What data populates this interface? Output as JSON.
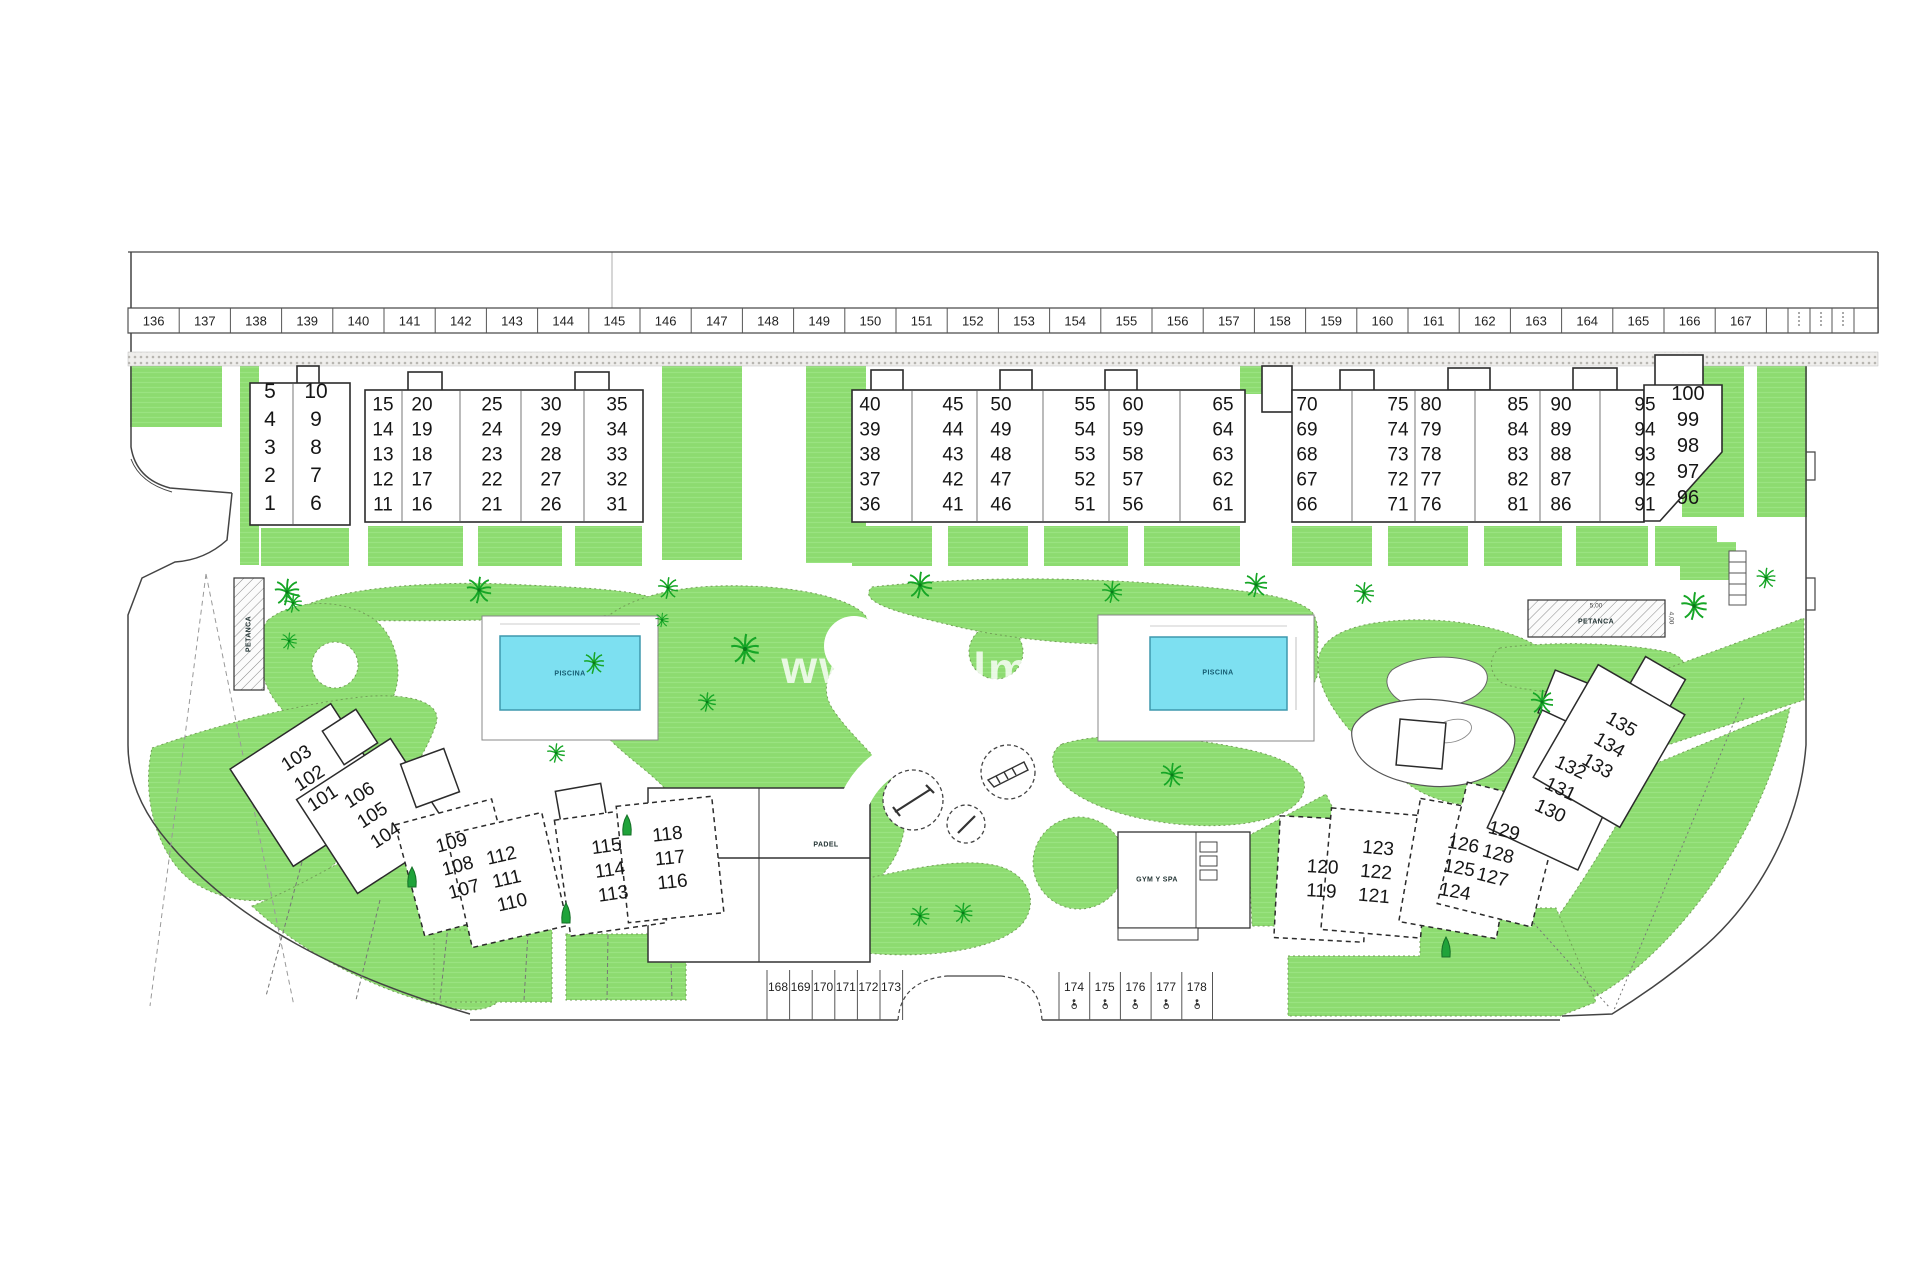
{
  "watermark": {
    "prefix": "www",
    "fragment": "dpalme"
  },
  "parking_top": [
    "136",
    "137",
    "138",
    "139",
    "140",
    "141",
    "142",
    "143",
    "144",
    "145",
    "146",
    "147",
    "148",
    "149",
    "150",
    "151",
    "152",
    "153",
    "154",
    "155",
    "156",
    "157",
    "158",
    "159",
    "160",
    "161",
    "162",
    "163",
    "164",
    "165",
    "166",
    "167"
  ],
  "parking_bottom_left": [
    "168",
    "169",
    "170",
    "171",
    "172",
    "173"
  ],
  "parking_bottom_right": [
    "174",
    "175",
    "176",
    "177",
    "178"
  ],
  "units_upper": [
    [
      5,
      4,
      3,
      2,
      1
    ],
    [
      10,
      9,
      8,
      7,
      6
    ],
    [
      15,
      14,
      13,
      12,
      11
    ],
    [
      20,
      19,
      18,
      17,
      16
    ],
    [
      25,
      24,
      23,
      22,
      21
    ],
    [
      30,
      29,
      28,
      27,
      26
    ],
    [
      35,
      34,
      33,
      32,
      31
    ],
    [
      40,
      39,
      38,
      37,
      36
    ],
    [
      45,
      44,
      43,
      42,
      41
    ],
    [
      50,
      49,
      48,
      47,
      46
    ],
    [
      55,
      54,
      53,
      52,
      51
    ],
    [
      60,
      59,
      58,
      57,
      56
    ],
    [
      65,
      64,
      63,
      62,
      61
    ],
    [
      70,
      69,
      68,
      67,
      66
    ],
    [
      75,
      74,
      73,
      72,
      71
    ],
    [
      80,
      79,
      78,
      77,
      76
    ],
    [
      85,
      84,
      83,
      82,
      81
    ],
    [
      90,
      89,
      88,
      87,
      86
    ],
    [
      95,
      94,
      93,
      92,
      91
    ],
    [
      100,
      99,
      98,
      97,
      96
    ]
  ],
  "units_lower": [
    [
      103,
      102,
      101
    ],
    [
      106,
      105,
      104
    ],
    [
      109,
      108,
      107
    ],
    [
      112,
      111,
      110
    ],
    [
      115,
      114,
      113
    ],
    [
      118,
      117,
      116
    ],
    [
      120,
      119
    ],
    [
      123,
      122,
      121
    ],
    [
      126,
      125,
      124
    ],
    [
      129,
      128,
      127
    ],
    [
      132,
      131,
      130
    ],
    [
      135,
      134,
      133
    ]
  ],
  "facilities": {
    "pool_label": "PISCINA",
    "petanca_label": "PETANCA",
    "petanca_dim_w": "5,00",
    "petanca_dim_h": "4,00",
    "padel_label": "PADEL",
    "gym_label": "GYM Y SPA"
  },
  "colors": {
    "lawn": "#8ddb70",
    "pool_water": "#7de0f1",
    "palm": "#16a626"
  }
}
